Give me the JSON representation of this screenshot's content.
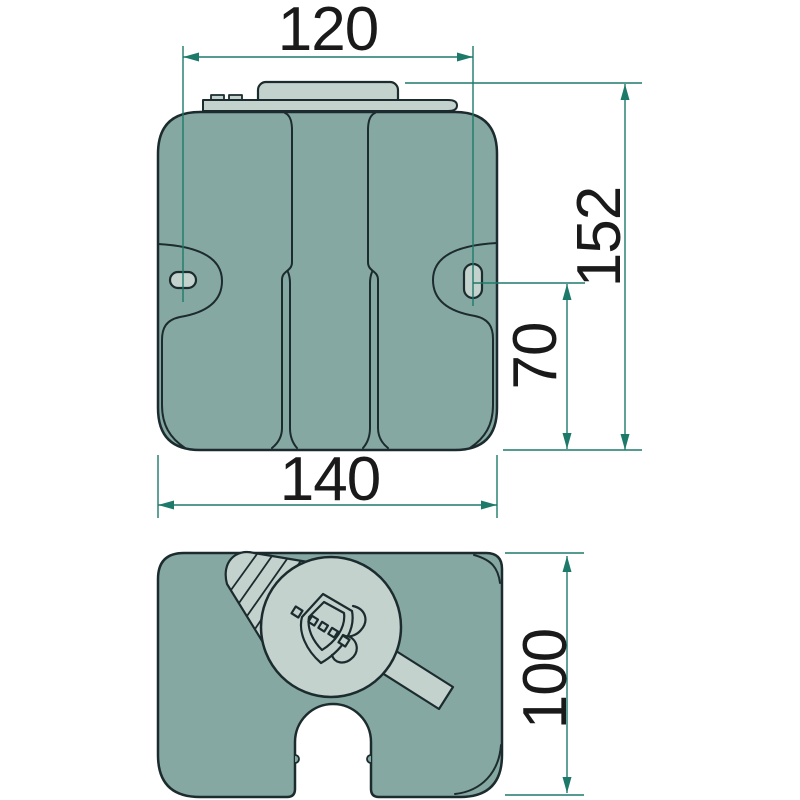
{
  "drawing": {
    "type": "technical-drawing",
    "subject": "washer-fluid-tank",
    "views": {
      "front": "front-view-of-tank-with-filler-cap-and-mounting-holes",
      "bottom": "bottom-view-of-tank-with-washer-pump"
    },
    "dimensions": {
      "top_width": "120",
      "total_height": "152",
      "hole_to_bottom": "70",
      "overall_width": "140",
      "depth": "100"
    },
    "icons": {
      "pump_symbol": "windscreen-washer-spray-icon"
    },
    "colors": {
      "body_fill": "#86A8A3",
      "part_fill": "#C3D2CC",
      "outline": "#1C2B2E",
      "dimension_lines": "#1D7A6A",
      "text": "#1A1A1A",
      "background": "#FFFFFF"
    }
  }
}
